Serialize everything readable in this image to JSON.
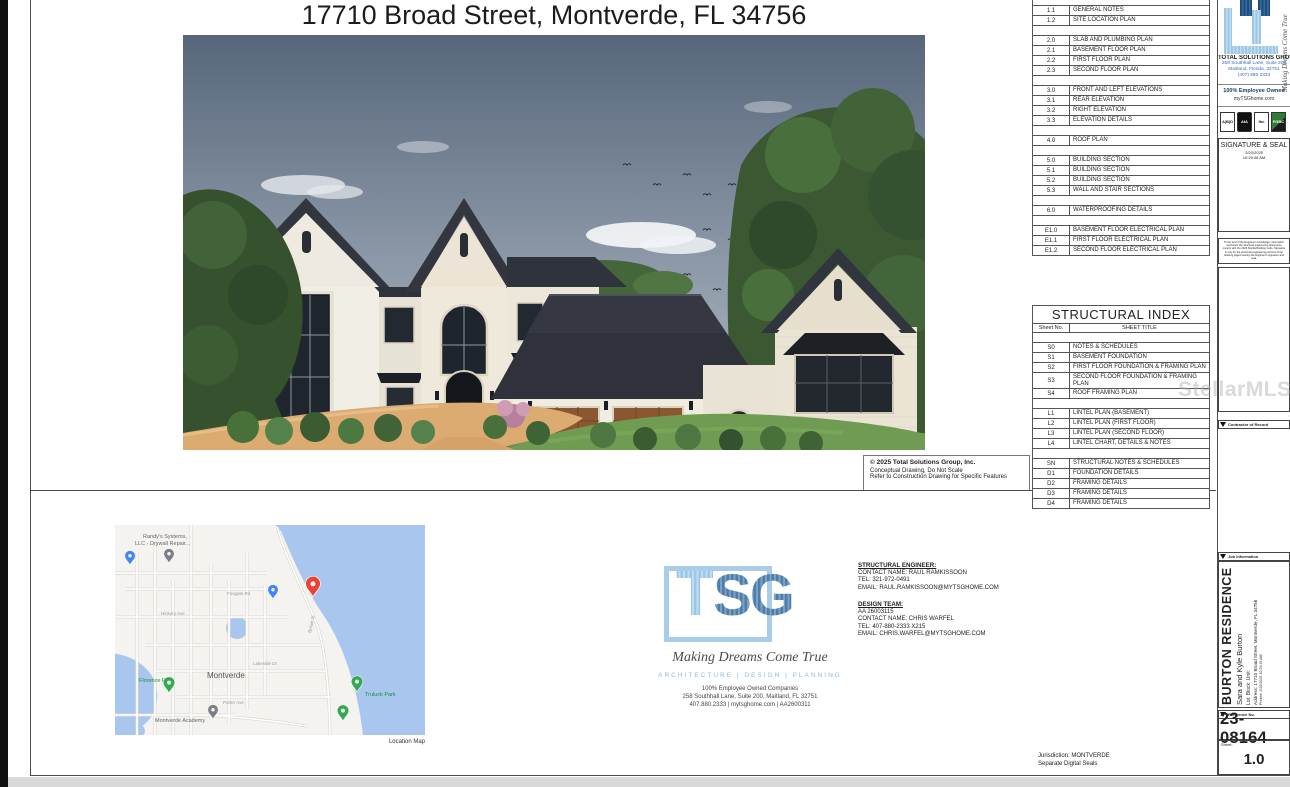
{
  "page": {
    "title": "17710 Broad Street, Montverde, FL 34756",
    "watermark": "StellarMLS"
  },
  "rendering_caption": {
    "line1": "© 2025 Total Solutions Group, Inc.",
    "line2": "Conceptual Drawing, Do Not Scale",
    "line3": "Refer to Construction Drawing for Specific Features"
  },
  "sheet_index": {
    "rows": [
      {
        "no": "",
        "title": ""
      },
      {
        "no": "1.1",
        "title": "GENERAL NOTES"
      },
      {
        "no": "1.2",
        "title": "SITE LOCATION PLAN"
      },
      {
        "no": "",
        "title": ""
      },
      {
        "no": "2.0",
        "title": "SLAB AND PLUMBING PLAN"
      },
      {
        "no": "2.1",
        "title": "BASEMENT FLOOR PLAN"
      },
      {
        "no": "2.2",
        "title": "FIRST FLOOR PLAN"
      },
      {
        "no": "2.3",
        "title": "SECOND FLOOR PLAN"
      },
      {
        "no": "",
        "title": ""
      },
      {
        "no": "3.0",
        "title": "FRONT AND LEFT ELEVATIONS"
      },
      {
        "no": "3.1",
        "title": "REAR ELEVATION"
      },
      {
        "no": "3.2",
        "title": "RIGHT ELEVATION"
      },
      {
        "no": "3.3",
        "title": "ELEVATION DETAILS"
      },
      {
        "no": "",
        "title": ""
      },
      {
        "no": "4.0",
        "title": "ROOF PLAN"
      },
      {
        "no": "",
        "title": ""
      },
      {
        "no": "5.0",
        "title": "BUILDING SECTION"
      },
      {
        "no": "5.1",
        "title": "BUILDING SECTION"
      },
      {
        "no": "5.2",
        "title": "BUILDING SECTION"
      },
      {
        "no": "5.3",
        "title": "WALL AND STAIR SECTIONS"
      },
      {
        "no": "",
        "title": ""
      },
      {
        "no": "6.0",
        "title": "WATERPROOFING DETAILS"
      },
      {
        "no": "",
        "title": ""
      },
      {
        "no": "E1.0",
        "title": "BASEMENT FLOOR ELECTRICAL PLAN"
      },
      {
        "no": "E1.1",
        "title": "FIRST FLOOR ELECTRICAL PLAN"
      },
      {
        "no": "E1.2",
        "title": "SECOND FLOOR ELECTRICAL PLAN"
      }
    ]
  },
  "structural_index": {
    "title": "STRUCTURAL INDEX",
    "col1": "Sheet No.",
    "col2": "SHEET TITLE",
    "rows": [
      {
        "no": "",
        "title": ""
      },
      {
        "no": "S0",
        "title": "NOTES & SCHEDULES"
      },
      {
        "no": "S1",
        "title": "BASEMENT FOUNDATION"
      },
      {
        "no": "S2",
        "title": "FIRST FLOOR FOUNDATION & FRAMING PLAN"
      },
      {
        "no": "S3",
        "title": "SECOND FLOOR FOUNDATION & FRAMING PLAN"
      },
      {
        "no": "S4",
        "title": "ROOF FRAMING PLAN"
      },
      {
        "no": "",
        "title": ""
      },
      {
        "no": "L1",
        "title": "LINTEL PLAN (BASEMENT)"
      },
      {
        "no": "L2",
        "title": "LINTEL PLAN (FIRST FLOOR)"
      },
      {
        "no": "L3",
        "title": "LINTEL PLAN (SECOND FLOOR)"
      },
      {
        "no": "L4",
        "title": "LINTEL CHART, DETAILS & NOTES"
      },
      {
        "no": "",
        "title": ""
      },
      {
        "no": "SN",
        "title": "STRUCTURAL NOTES & SCHEDULES"
      },
      {
        "no": "D1",
        "title": "FOUNDATION DETAILS"
      },
      {
        "no": "D2",
        "title": "FRAMING DETAILS"
      },
      {
        "no": "D3",
        "title": "FRAMING DETAILS"
      },
      {
        "no": "D4",
        "title": "FRAMING DETAILS"
      }
    ]
  },
  "location_map": {
    "caption": "Location Map",
    "labels": [
      {
        "text": "Randy's Systems,",
        "x": 28,
        "y": 13,
        "c": "#666666",
        "s": 5.5
      },
      {
        "text": "LLC - Drywall Repair...",
        "x": 20,
        "y": 20,
        "c": "#666666",
        "s": 5.5
      },
      {
        "text": "Fosgate Rd",
        "x": 112,
        "y": 70,
        "c": "#9a9a9a",
        "s": 4.5
      },
      {
        "text": "Hickory Ave",
        "x": 46,
        "y": 90,
        "c": "#9a9a9a",
        "s": 4.5
      },
      {
        "text": "Lakeside Dr",
        "x": 138,
        "y": 140,
        "c": "#9a9a9a",
        "s": 4.5
      },
      {
        "text": "Montverde",
        "x": 92,
        "y": 153,
        "c": "#555555",
        "s": 8
      },
      {
        "text": "Porter Ave",
        "x": 108,
        "y": 179,
        "c": "#9a9a9a",
        "s": 4.5
      },
      {
        "text": "Florence Park",
        "x": 24,
        "y": 157,
        "c": "#1e8e3e",
        "s": 5.5
      },
      {
        "text": "Truluck Park",
        "x": 250,
        "y": 171,
        "c": "#1e8e3e",
        "s": 5.5
      },
      {
        "text": "Montverde Academy",
        "x": 40,
        "y": 197,
        "c": "#5f6b63",
        "s": 5.5
      },
      {
        "text": "Broad St",
        "x": 196,
        "y": 108,
        "c": "#9a9a9a",
        "s": 4.5,
        "r": -78
      }
    ],
    "pins": [
      {
        "x": 54,
        "y": 38,
        "c": "#7b8087",
        "k": 0.8
      },
      {
        "x": 15,
        "y": 40,
        "c": "#4285f4",
        "k": 0.8
      },
      {
        "x": 158,
        "y": 74,
        "c": "#4285f4",
        "k": 0.8
      },
      {
        "x": 198,
        "y": 72,
        "c": "#ea4335",
        "k": 1.15
      },
      {
        "x": 54,
        "y": 168,
        "c": "#34a853",
        "k": 0.9
      },
      {
        "x": 242,
        "y": 167,
        "c": "#34a853",
        "k": 0.9
      },
      {
        "x": 228,
        "y": 196,
        "c": "#34a853",
        "k": 0.9
      },
      {
        "x": 98,
        "y": 194,
        "c": "#7b8087",
        "k": 0.8
      }
    ]
  },
  "tsg_logo": {
    "letter_t": "T",
    "letters_sg": "SG",
    "tagline": "Making Dreams Come True",
    "services": "ARCHITECTURE | DESIGN | PLANNING",
    "addr1": "100% Employee Owned Companies",
    "addr2": "258 Southhall Lane, Suite 200, Maitland, FL 32751",
    "addr3": "407.880.2333 | mytsghome.com | AA2600311"
  },
  "contacts": {
    "structural_engineer": {
      "heading": "STRUCTURAL ENGINEER:",
      "contact": "CONTACT NAME: RAUL RAMKISSOON",
      "tel": "TEL: 321-972-0491",
      "email": "EMAIL: RAUL.RAMKISSOON@MYTSGHOME.COM"
    },
    "design_team": {
      "heading": "DESIGN TEAM:",
      "license": "AA 26003115",
      "contact": "CONTACT NAME: CHRIS WARFEL",
      "tel": "TEL: 407-880-2333 X215",
      "email": "EMAIL: CHRIS.WARFEL@MYTSGHOME.COM"
    }
  },
  "jurisdiction": {
    "line1": "Jurisdiction: MONTVERDE",
    "line2": "Separate Digital Seals"
  },
  "title_block": {
    "script": "Making Dreams Come True",
    "company_name": "TOTAL SOLUTIONS GROUP",
    "company_addr1": "258 Southhall Lane, Suite 200",
    "company_addr2": "Maitland, Florida, 32751",
    "company_phone": "(407) 880 2333",
    "owned": "100% Employee Owned",
    "website": "myTSGhome.com",
    "badges": [
      {
        "label": "A|B|D",
        "kind": "aibd"
      },
      {
        "label": "AIA",
        "kind": "aia"
      },
      {
        "label": "fbc",
        "kind": "fbc"
      },
      {
        "label": "FGBC",
        "kind": "fgbc"
      }
    ],
    "signature": {
      "title": "SIGNATURE & SEAL",
      "date": "2/20/2025",
      "time": "10:29:46 AM"
    },
    "disclaimer": "To the best of the Engineer's knowledge, information and belief, the structural engineering documents comply with the 2023 Florida Building Code. Signature is only for the structural engineering portions of the drawing pages bearing the Engineer's signature and seal.",
    "contractor_header": "Contractor of Record",
    "job_header": "Job Information",
    "job": {
      "residence": "BURTON RESIDENCE",
      "owners": "Sara and Kyle Burton",
      "labels": "Lot:      Block:      Unit:",
      "address": "Address:  17710 Broad Street, Montverde, FL 34756",
      "printed": "Printed:  2/20/2025 10:29:45 AM"
    },
    "reference_header": "Reference No.",
    "reference_no": "23-08164",
    "sheet_label": "Sheet:",
    "sheet_no": "1.0"
  }
}
